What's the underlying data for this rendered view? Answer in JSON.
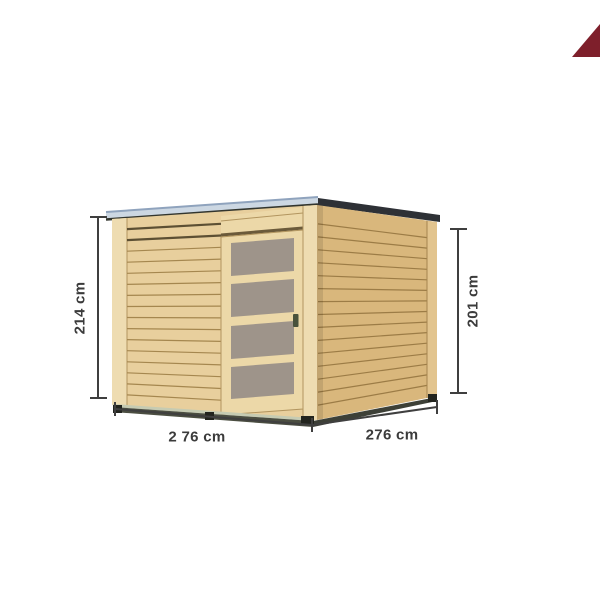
{
  "page": {
    "background_color": "#ffffff"
  },
  "badge": {
    "icon": "corner-triangle-badge",
    "color": "#7E1F2B"
  },
  "product": {
    "name": "wooden-garden-cabin-with-glazed-sliding-door",
    "view": "front-right-perspective-dimension-diagram",
    "dimensions": {
      "height_left": "214 cm",
      "height_right": "201 cm",
      "width_front": "2 76 cm",
      "depth_side": "276 cm"
    },
    "colors": {
      "wood_front": "#e8cf9d",
      "wood_side": "#d9b77c",
      "trim_front": "#eedcb1",
      "trim_side": "#e2c48e",
      "plank_gap": "#a5874f",
      "plank_gap_dark": "#5c4f33",
      "plank_gap_side": "#9c7c46",
      "roof_top": "#ccd7e2",
      "roof_edge_line": "#8fa3bd",
      "roof_shadow": "#32352e",
      "fascia_dark": "#2e3136",
      "door_wood": "#ecd8a8",
      "header_shadow": "#6b5a3a",
      "glass": "#9e948a",
      "glass_edge": "#756b60",
      "handle": "#49523c",
      "sill_light": "#c6cbb2",
      "base_dark": "#4b4e41",
      "base_dark_side": "#3d4037",
      "foot": "#22241e",
      "dimension_line": "#3f3f3f",
      "dimension_text": "#3b3b3b"
    }
  }
}
